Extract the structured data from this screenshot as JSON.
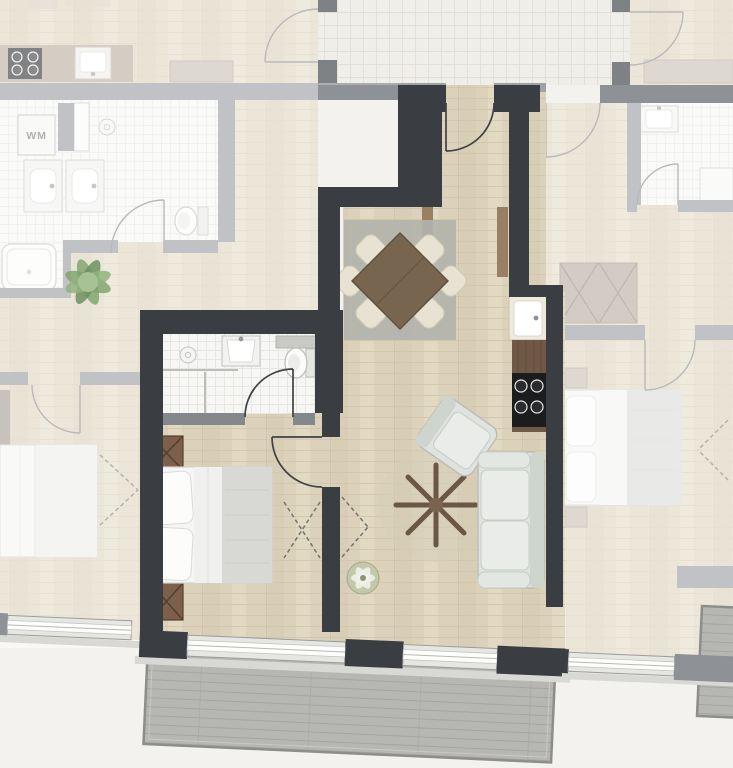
{
  "labels": {
    "washing_machine": "WM"
  },
  "palette": {
    "background": "#f3f2ef",
    "wall_main": "#3a3d41",
    "wall_neighbor": "#8e9195",
    "wall_interior": "#84878c",
    "wall_cap": "#9fa2a5",
    "floor_wood": "#dcd2bb",
    "tile": "#f6f6f4",
    "tile_line": "#e6e6e3",
    "corridor_tile": "#eae8e0",
    "corridor_line": "#d9d6cc",
    "deck": "#b6b6b2",
    "deck_line": "#a4a4a0",
    "deck_border": "#8d8d8a",
    "sill": "#d8d8d4",
    "window_glass": "#fdfdfc",
    "window_frame": "#e6e6e3",
    "rug": "#b1b3ac",
    "rug_round": "#d6cdb9",
    "table_wood": "#77654f",
    "chair": "#e8e2d2",
    "sofa": "#dfe2dd",
    "sofa_stroke": "#b7bdb7",
    "cushion": "#e9ece8",
    "counter_wood": "#6f5946",
    "hob": "#1b1c1e",
    "fixture": "#fbfbfa",
    "fixture_stroke": "#bdbdba",
    "bed_white": "#f5f5f3",
    "bed_blanket": "#d8d9d5",
    "nightstand": "#7c604a",
    "plant": "#7ba268",
    "fade": "rgba(255,255,255,0.45)",
    "door_main": "#3f4245",
    "door_neighbor": "#7d8084",
    "dash": "#74746d",
    "console_wood": "#9b7f63",
    "sideboard": "#c2b8a9"
  }
}
